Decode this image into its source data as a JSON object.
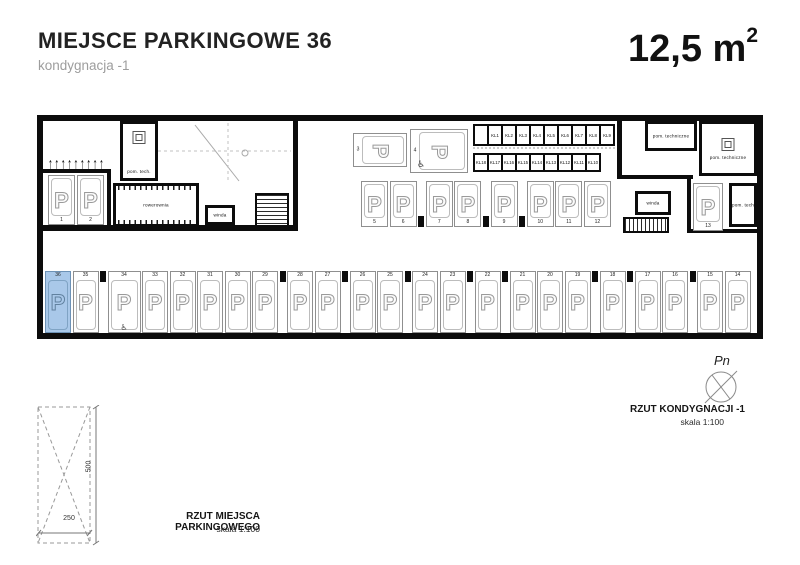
{
  "header": {
    "title": "MIEJSCE PARKINGOWE 36",
    "subtitle": "kondygnacja -1",
    "area": "12,5 m",
    "area_sup": "2"
  },
  "plan": {
    "highlight_color": "#a9c8e9",
    "highlighted_space": "36",
    "rooms": {
      "pom_tech_left": "pom. tech.",
      "rowerownia": "rowerownia",
      "winda_left": "winda",
      "pom_techniczne_a": "pom. techniczne",
      "pom_techniczne_b": "pom. techniczne",
      "winda_right": "winda",
      "pom_tech_right": "pom. tech."
    },
    "spaces": {
      "left_pair": [
        "1",
        "2"
      ],
      "horizontal": [
        {
          "num": "3",
          "accessible": false
        },
        {
          "num": "4",
          "accessible": true
        }
      ],
      "top_row": [
        "5",
        "6",
        "7",
        "8",
        "9",
        "10",
        "11",
        "12"
      ],
      "right_single": "13",
      "bottom_row": [
        "36",
        "35",
        "34",
        "33",
        "32",
        "31",
        "30",
        "29",
        "28",
        "27",
        "26",
        "25",
        "24",
        "23",
        "22",
        "21",
        "20",
        "19",
        "18",
        "17",
        "16",
        "15",
        "14"
      ],
      "accessible": [
        "4",
        "34"
      ]
    },
    "lockers": {
      "top": [
        "KL1",
        "KL2",
        "KL3",
        "KL4",
        "KL5",
        "KL6",
        "KL7",
        "KL8",
        "KL9"
      ],
      "bottom": [
        "KL18",
        "KL17",
        "KL16",
        "KL15",
        "KL14",
        "KL13",
        "KL12",
        "KL11",
        "KL10"
      ]
    },
    "icons": {
      "bay": "P",
      "wheelchair": "♿",
      "rack_arrow": "↑"
    }
  },
  "footer": {
    "detail": {
      "title": "RZUT MIEJSCA PARKINGOWEGO",
      "scale": "skala 1:100",
      "width_dim": "250",
      "height_dim": "500"
    },
    "north": {
      "label": "Pn",
      "title": "RZUT KONDYGNACJI -1",
      "scale": "skala 1:100"
    }
  }
}
